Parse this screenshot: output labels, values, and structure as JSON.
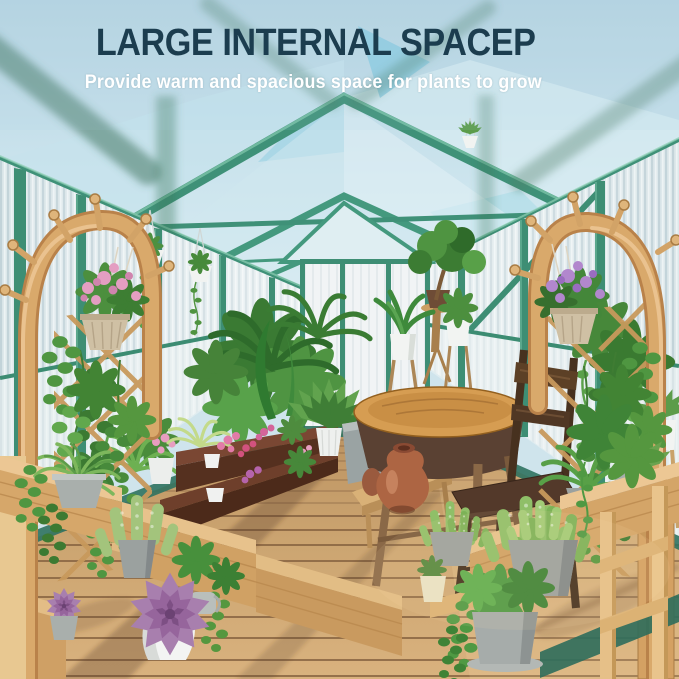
{
  "image": {
    "kind": "product marketing photo",
    "scene": "Interior of a polycarbonate greenhouse with a green aluminum gable frame, wooden arched peg trellises with hanging flower baskets, tiered wooden step shelves full of potted plants and succulents, a round wooden bistro table with a rustic chair and terracotta vase, and a wooden deck walkway"
  },
  "header": {
    "title": "LARGE INTERNAL SPACEP",
    "subtitle": "Provide warm and spacious space for plants to grow"
  },
  "colors": {
    "title_text": "#1c3d4f",
    "subtitle_text": "#ffffff",
    "frame_green": "#3f9178",
    "base_rail_teal": "#2f7260",
    "panel_blue": "#cfe7ee",
    "sky_blue": "#aacfdf",
    "wood_arch": "#d9a96b",
    "wood_deck": "#c9a26f",
    "wood_dark_bench": "#5b3b28",
    "table_top": "#d69d52",
    "terracotta": "#ad6543",
    "foliage_green": "#4a8f3f",
    "succulent_purple": "#a179a7",
    "flower_pink": "#e49ec2",
    "flower_purple": "#b287cd",
    "pot_grey": "#9ba19f",
    "pot_white": "#f4f5f4",
    "basket_tan": "#cfc0a4"
  },
  "scene_elements": [
    "gable greenhouse roof with nested green rafters",
    "striped translucent polycarbonate wall panels",
    "left arched wood plant stand with pegs and lattice",
    "right arched wood plant stand with pegs and lattice",
    "hanging basket with pink flowers",
    "hanging basket with purple flowers",
    "small white hanging planters",
    "dark wood display bench with flower pots",
    "round wooden bistro table",
    "rustic dark wooden chair",
    "terracotta vase",
    "grey planter box",
    "ficus tree on wooden stool",
    "peace lily on plant stand",
    "tiered wooden step shelf with fern, cactus and purple echeveria",
    "tiered wooden step shelf with haworthia, jade and pothos pots",
    "wooden deck walkway with plank shadows"
  ]
}
